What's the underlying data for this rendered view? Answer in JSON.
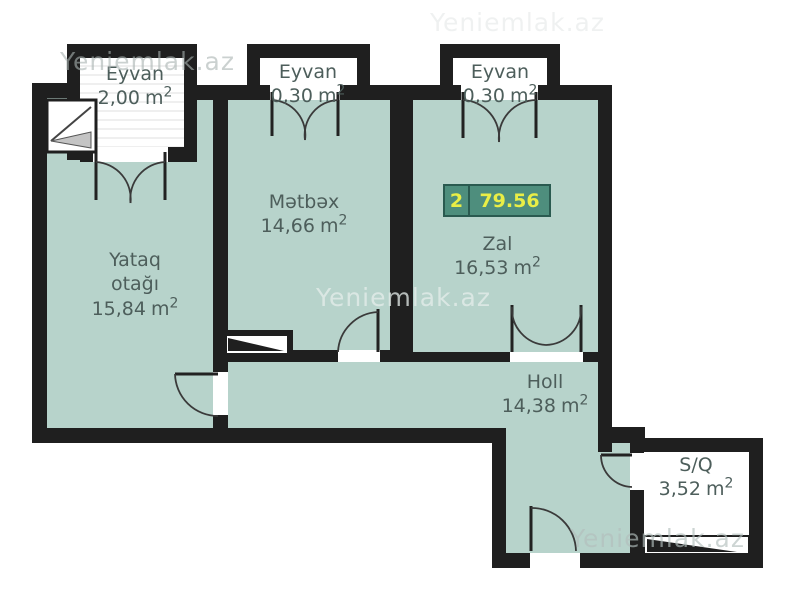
{
  "watermark": {
    "text": "Yeniemlak.az"
  },
  "badge": {
    "room_count": "2",
    "total_area": "79.56"
  },
  "unit": {
    "base": "m",
    "sup": "2"
  },
  "colors": {
    "floor_teal": "#b7d3cb",
    "wall_black": "#1f1f1f",
    "badge_background": "#4e8e7d",
    "badge_border": "#2a5a50",
    "badge_text_yellow": "#e9ee46",
    "label_text": "#4d5e5b"
  },
  "rooms": {
    "eyvan_top_left": {
      "name": "Eyvan",
      "area": "2,00"
    },
    "eyvan_top_middle": {
      "name": "Eyvan",
      "area": "0,30"
    },
    "eyvan_top_right": {
      "name": "Eyvan",
      "area": "0,30"
    },
    "matbax": {
      "name": "Mətbəx",
      "area": "14,66"
    },
    "zal": {
      "name": "Zal",
      "area": "16,53"
    },
    "yataq": {
      "name_line1": "Yataq",
      "name_line2": "otağı",
      "area": "15,84"
    },
    "holl": {
      "name": "Holl",
      "area": "14,38"
    },
    "sq": {
      "name": "S/Q",
      "area": "3,52"
    }
  }
}
